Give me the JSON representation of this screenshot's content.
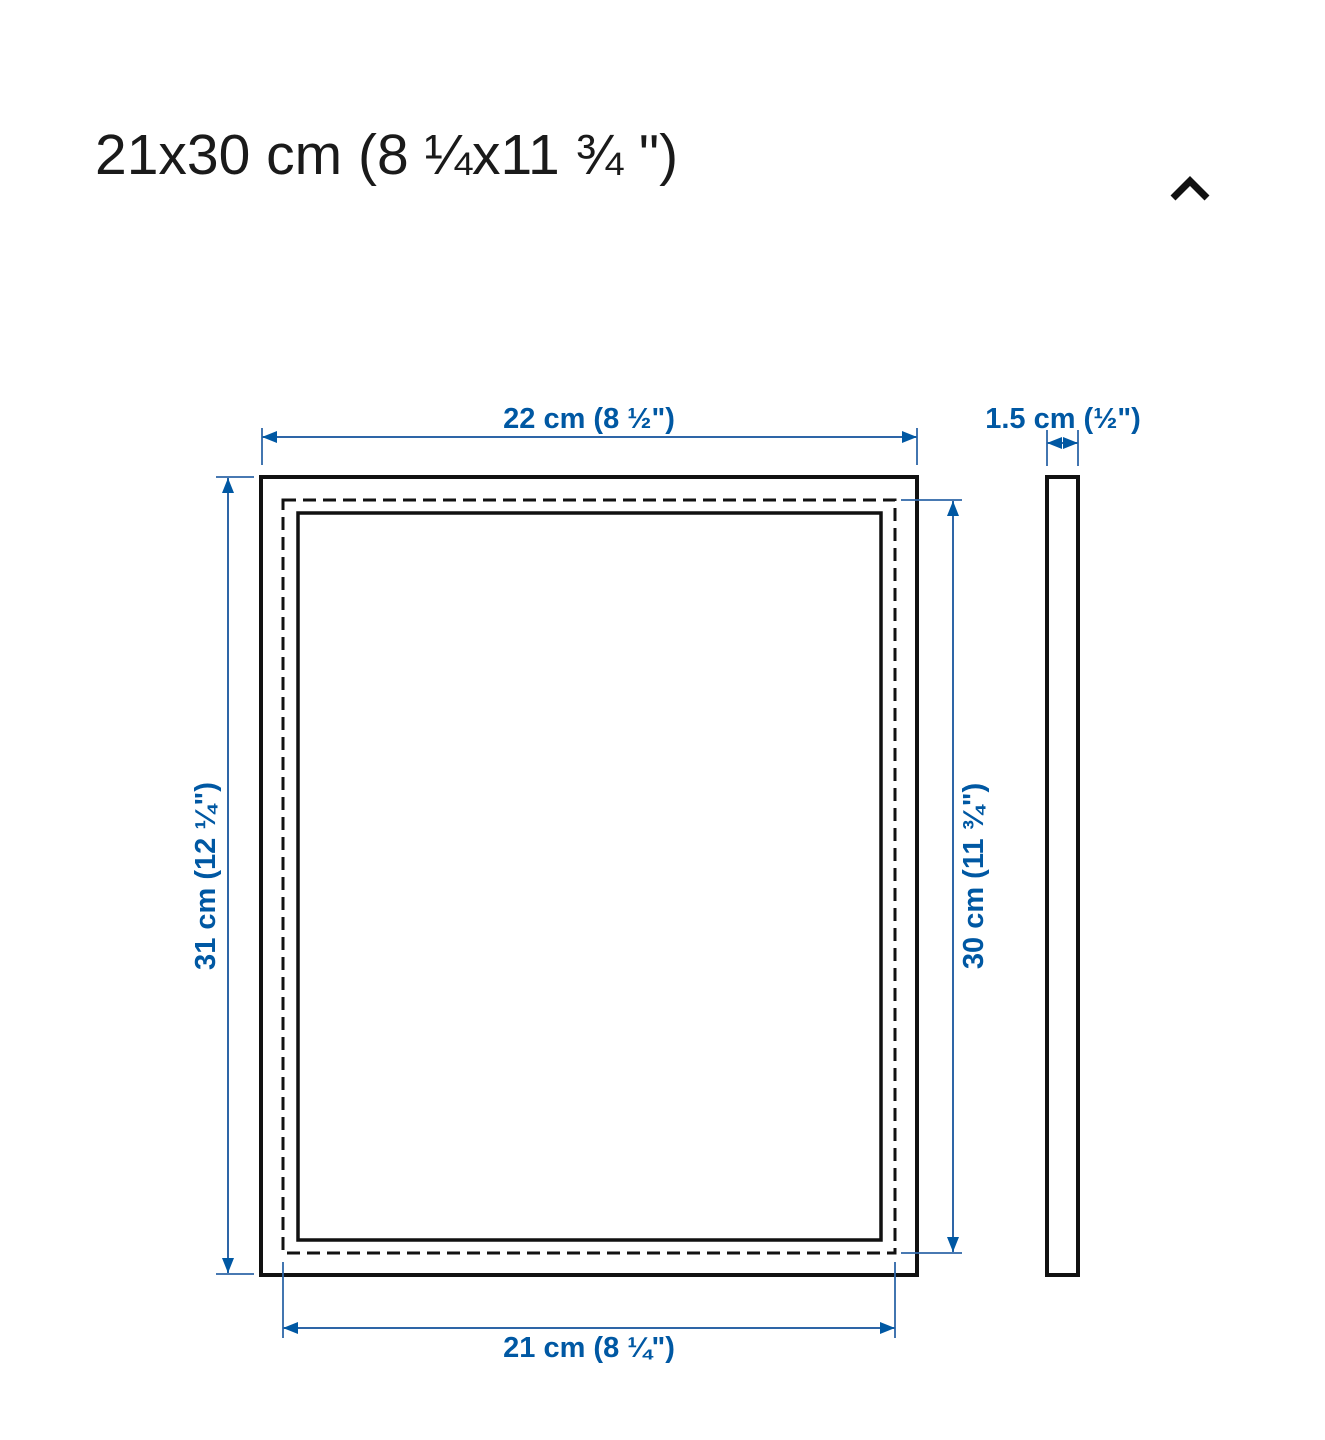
{
  "header": {
    "title": "21x30 cm (8 ¼x11 ¾ \")",
    "collapse_icon": "chevron-up-icon"
  },
  "diagram": {
    "front_view": {
      "outer_width": "22 cm (8 ½\")",
      "outer_height": "31 cm (12 ¼\")",
      "picture_height": "30 cm (11 ¾\")",
      "picture_width": "21 cm (8 ¼\")"
    },
    "side_view": {
      "depth": "1.5 cm (½\")"
    },
    "colors": {
      "dimension_text": "#0058a3",
      "dimension_line": "#2e66a7",
      "outline": "#111111"
    }
  }
}
